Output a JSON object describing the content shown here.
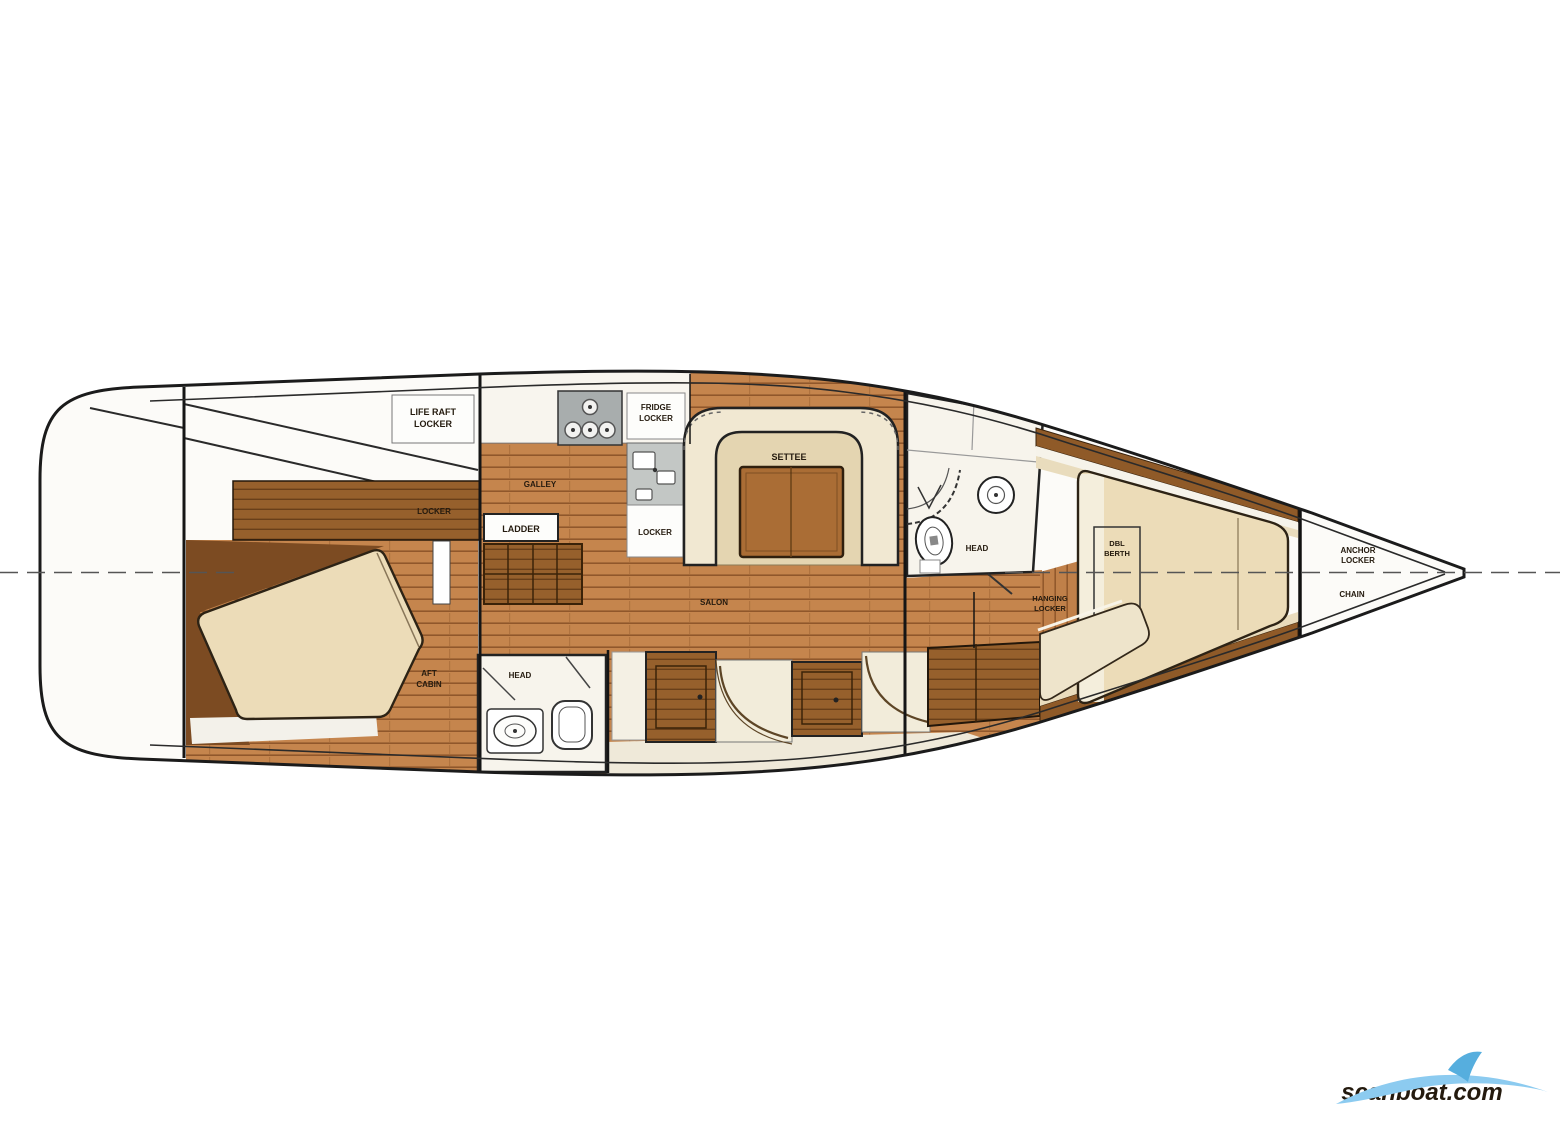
{
  "labels": {
    "cockpit_locker_1": "LIFE RAFT",
    "cockpit_locker_2": "LOCKER",
    "hatch_locker": "LOCKER",
    "aft_cabin_1": "AFT",
    "aft_cabin_2": "CABIN",
    "galley": "GALLEY",
    "fridge_1": "FRIDGE",
    "fridge_2": "LOCKER",
    "sink_locker": "LOCKER",
    "ladder": "LADDER",
    "settee": "SETTEE",
    "salon": "SALON",
    "aft_head": "HEAD",
    "fwd_head": "HEAD",
    "fwd_locker_1": "HANGING",
    "fwd_locker_2": "LOCKER",
    "vberth_1": "DBL",
    "vberth_2": "BERTH",
    "anchor_1": "ANCHOR",
    "anchor_2": "LOCKER",
    "chain": "CHAIN"
  },
  "watermark": {
    "text": "scanboat.com",
    "color": "#8ccbf0"
  },
  "colors": {
    "hull_outline": "#1b1b1b",
    "floor_wood": "#c5854d",
    "dark_wood": "#8f5a28",
    "cushion": "#ecdcb8",
    "upholstery": "#f1e8d2",
    "fixture_grey": "#9aa0a0",
    "room_white": "#f7f4ec"
  }
}
